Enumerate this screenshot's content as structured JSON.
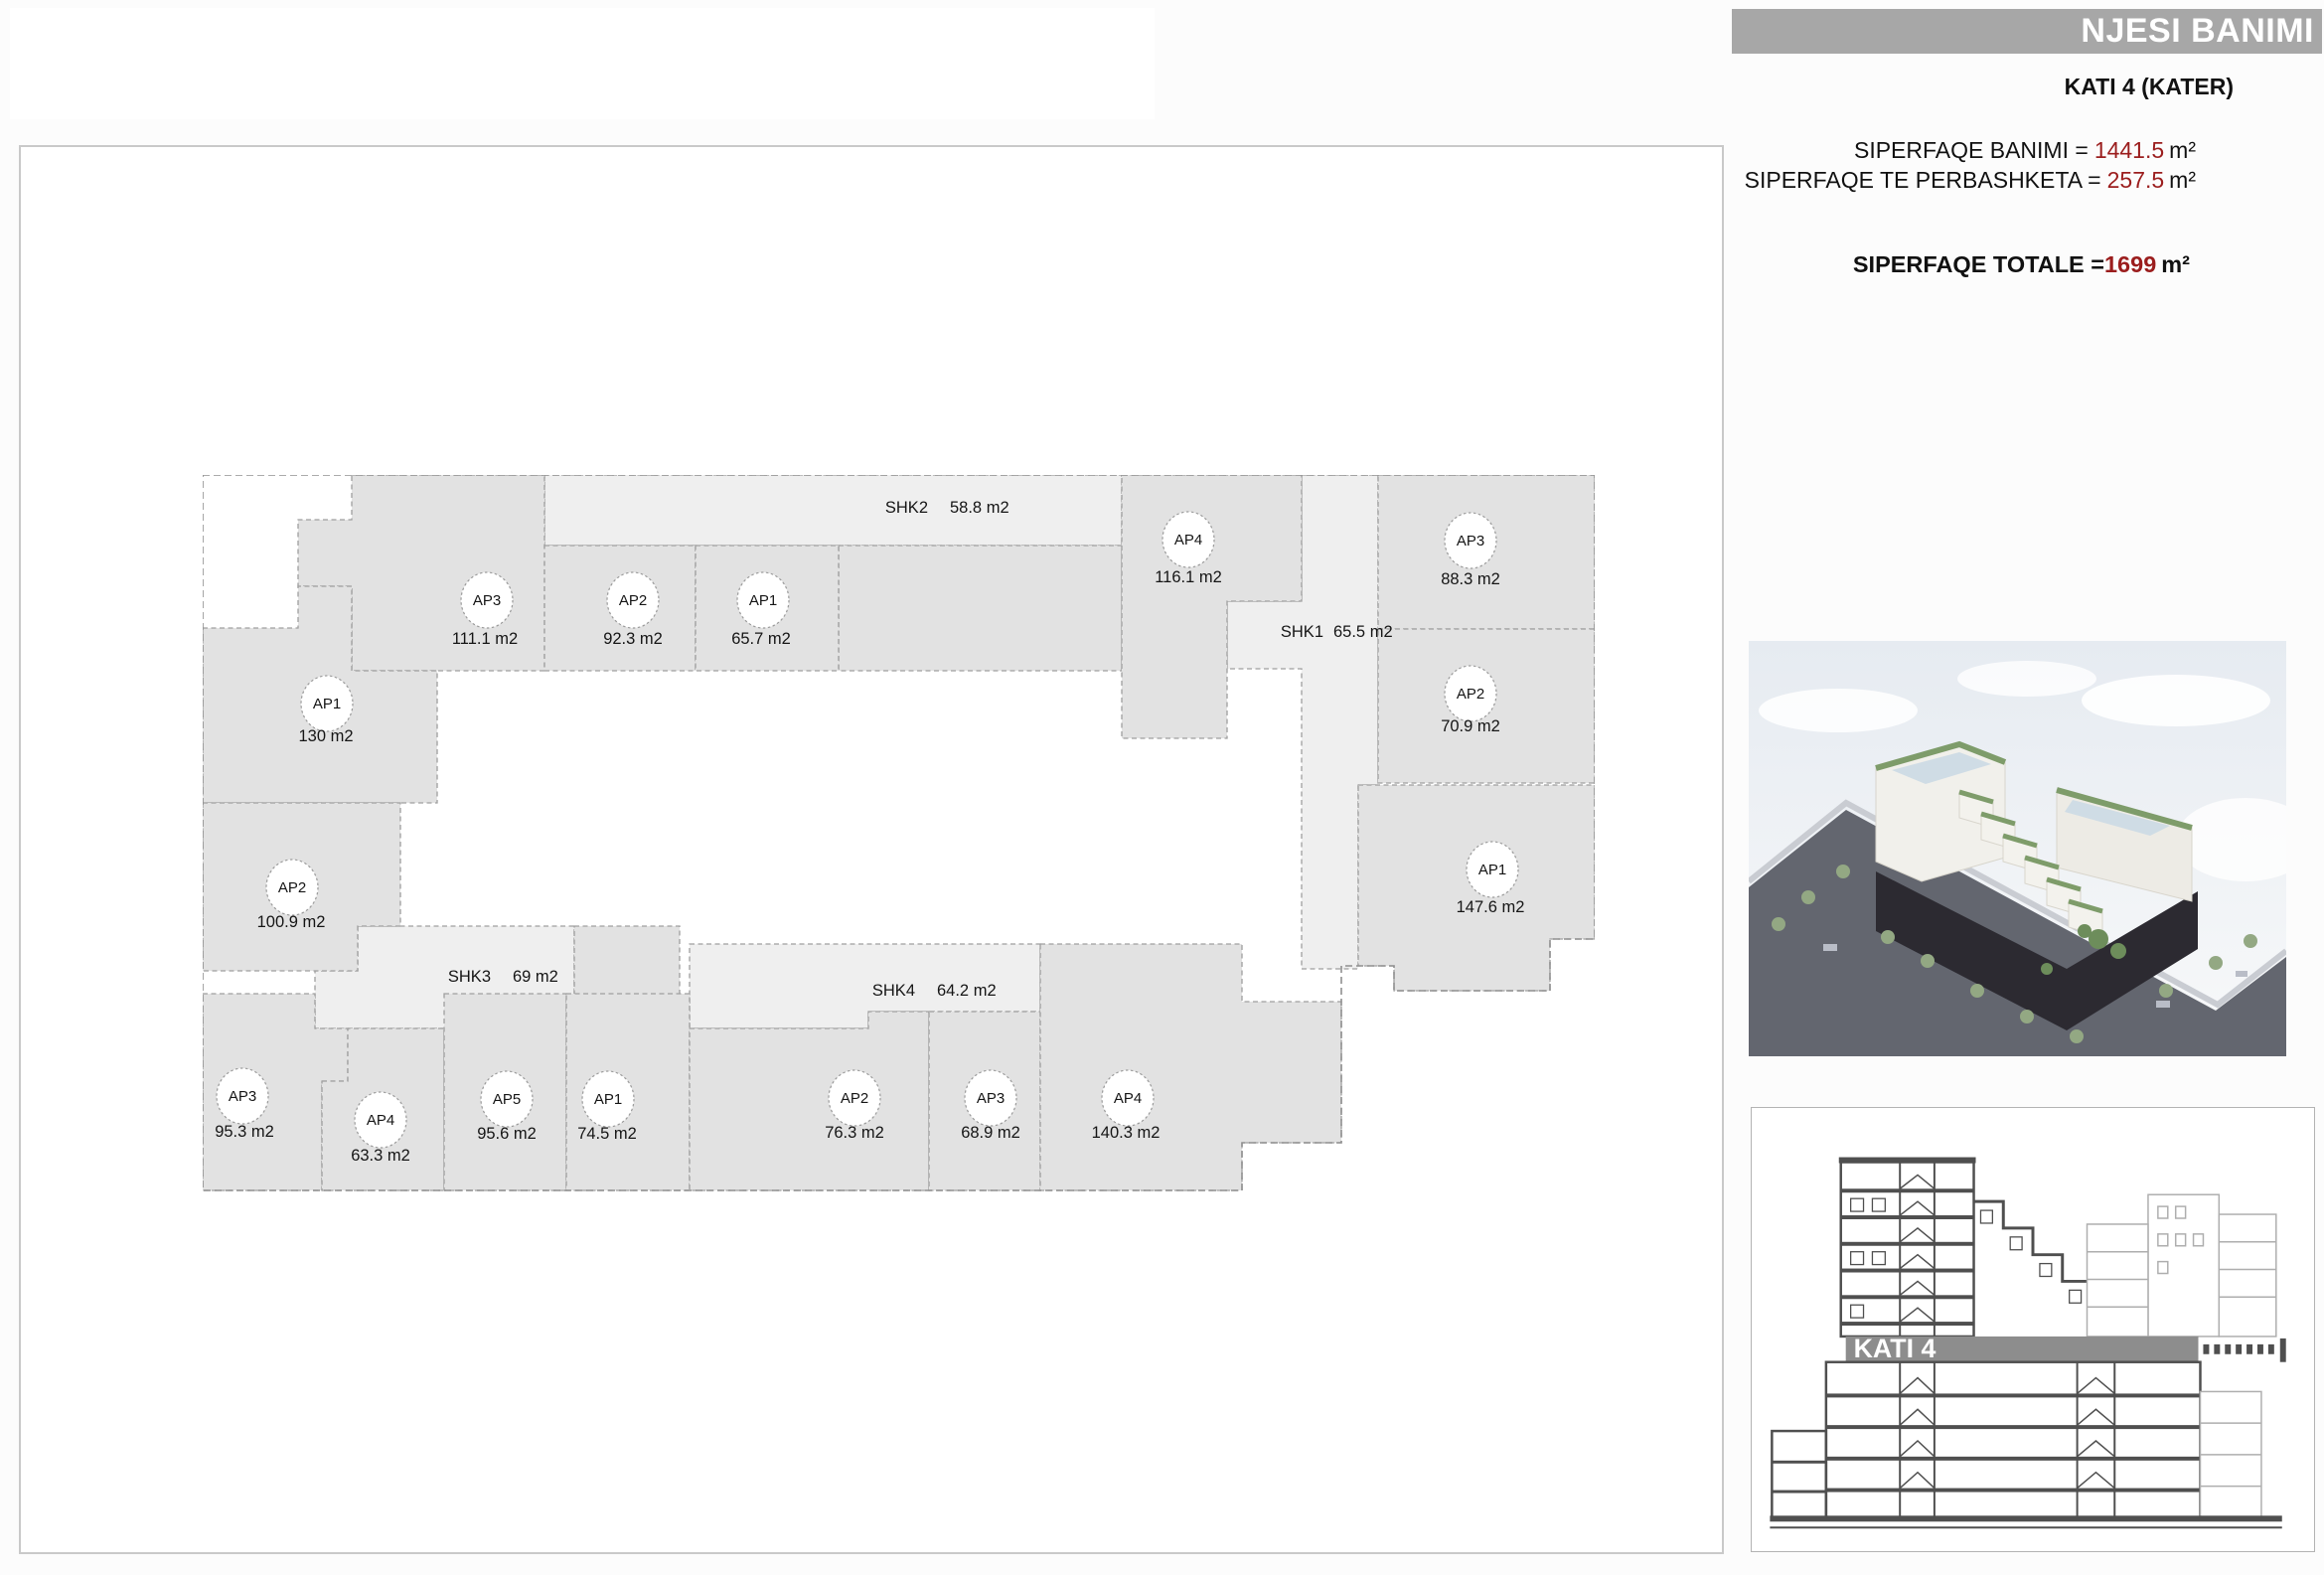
{
  "header": {
    "title": "NJESI BANIMI",
    "floor": "KATI 4 (KATER)",
    "stats": [
      {
        "label": "SIPERFAQE BANIMI =",
        "value": "1441.5",
        "unit": "m²"
      },
      {
        "label": "SIPERFAQE TE PERBASHKETA =",
        "value": "257.5",
        "unit": "m²"
      }
    ],
    "total": {
      "label": "SIPERFAQE TOTALE =",
      "value": "1699",
      "unit": "m²"
    },
    "accent_color": "#9b1d1d",
    "bar_color": "#a7a7a7"
  },
  "plan": {
    "rooms": [
      {
        "name": "AP3",
        "area": "111.1 m2"
      },
      {
        "name": "AP2",
        "area": "92.3 m2"
      },
      {
        "name": "AP1",
        "area": "65.7 m2"
      },
      {
        "name": "AP4",
        "area": "116.1 m2"
      },
      {
        "name": "AP3",
        "area": "88.3 m2"
      },
      {
        "name": "AP2",
        "area": "70.9 m2"
      },
      {
        "name": "AP1",
        "area": "130 m2"
      },
      {
        "name": "AP2",
        "area": "100.9 m2"
      },
      {
        "name": "AP1",
        "area": "147.6 m2"
      },
      {
        "name": "AP3",
        "area": "95.3 m2"
      },
      {
        "name": "AP4",
        "area": "63.3 m2"
      },
      {
        "name": "AP5",
        "area": "95.6 m2"
      },
      {
        "name": "AP1",
        "area": "74.5 m2"
      },
      {
        "name": "AP2",
        "area": "76.3 m2"
      },
      {
        "name": "AP3",
        "area": "68.9 m2"
      },
      {
        "name": "AP4",
        "area": "140.3 m2"
      }
    ],
    "corridors": [
      {
        "name": "SHK2",
        "area": "58.8 m2"
      },
      {
        "name": "SHK1",
        "area": "65.5 m2"
      },
      {
        "name": "SHK3",
        "area": "69 m2"
      },
      {
        "name": "SHK4",
        "area": "64.2 m2"
      }
    ],
    "room_fill": "#e2e2e2",
    "corridor_fill": "#efefef"
  },
  "section": {
    "band_label": "KATI 4"
  }
}
